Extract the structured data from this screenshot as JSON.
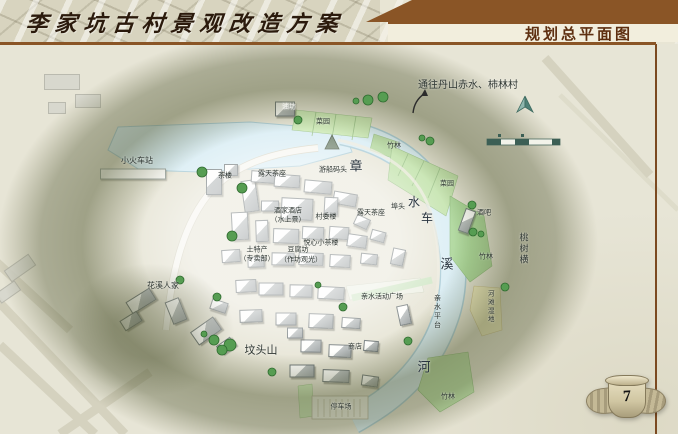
{
  "header": {
    "title_left": "李家坑古村景观改造方案",
    "title_right": "规划总平面图"
  },
  "page_number": "7",
  "colors": {
    "header_bar": "#8a5526",
    "rule_brown": "#7b4a21",
    "parchment": "#e7e5d6",
    "hill_shade": "#5d633e",
    "water": "#d9edf4",
    "water_edge": "#a9cbd6",
    "garden_green": "#cdeab6",
    "bamboo_green": "#a9d596",
    "wetland_yellow": "#eee9bd",
    "road": "#f7f6f0",
    "building_roof": "#9aa0a1",
    "tree_green": "#569d52",
    "north_arrow": "#4e8076",
    "emblem_stone": "#c9bfa4"
  },
  "map": {
    "route_note": "通往丹山赤水、柿林村",
    "river_name": "章溪河",
    "labels": [
      {
        "t": "通往丹山赤水、柿林村",
        "x": 468,
        "y": 86,
        "s": 10
      },
      {
        "t": "小火车站",
        "x": 137,
        "y": 161,
        "s": 8
      },
      {
        "t": "油坊",
        "x": 289,
        "y": 107,
        "s": 7,
        "c": "#f2f2ee"
      },
      {
        "t": "菜园",
        "x": 323,
        "y": 122,
        "s": 7
      },
      {
        "t": "竹林",
        "x": 394,
        "y": 146,
        "s": 7
      },
      {
        "t": "菜园",
        "x": 447,
        "y": 184,
        "s": 7
      },
      {
        "t": "茶楼",
        "x": 225,
        "y": 176,
        "s": 7
      },
      {
        "t": "露天茶座",
        "x": 272,
        "y": 174,
        "s": 7
      },
      {
        "t": "游船码头",
        "x": 333,
        "y": 170,
        "s": 7
      },
      {
        "t": "埠头",
        "x": 398,
        "y": 207,
        "s": 7
      },
      {
        "t": "露天茶座",
        "x": 371,
        "y": 213,
        "s": 7
      },
      {
        "t": "酒家酒店",
        "x": 288,
        "y": 211,
        "s": 7
      },
      {
        "t": "（水上景）",
        "x": 288,
        "y": 220,
        "s": 7
      },
      {
        "t": "村委楼",
        "x": 326,
        "y": 217,
        "s": 7
      },
      {
        "t": "酒吧",
        "x": 484,
        "y": 213,
        "s": 7
      },
      {
        "t": "悦心小茶楼",
        "x": 321,
        "y": 243,
        "s": 7
      },
      {
        "t": "土特产",
        "x": 257,
        "y": 250,
        "s": 7
      },
      {
        "t": "（专卖部）",
        "x": 257,
        "y": 259,
        "s": 7
      },
      {
        "t": "豆腐坊",
        "x": 298,
        "y": 250,
        "s": 7
      },
      {
        "t": "（作坊观光）",
        "x": 301,
        "y": 260,
        "s": 7
      },
      {
        "t": "章",
        "x": 356,
        "y": 166,
        "s": 13,
        "c": "#2a3540"
      },
      {
        "t": "水",
        "x": 414,
        "y": 202,
        "s": 12,
        "c": "#2a3540"
      },
      {
        "t": "车",
        "x": 427,
        "y": 218,
        "s": 12,
        "c": "#2a3540"
      },
      {
        "t": "溪",
        "x": 447,
        "y": 264,
        "s": 13,
        "c": "#2a3540"
      },
      {
        "t": "河",
        "x": 424,
        "y": 367,
        "s": 13,
        "c": "#2a3540"
      },
      {
        "t": "桃树横",
        "x": 523,
        "y": 249,
        "s": 9,
        "v": true
      },
      {
        "t": "竹林",
        "x": 486,
        "y": 257,
        "s": 7
      },
      {
        "t": "河滩湿地",
        "x": 489,
        "y": 307,
        "s": 6.5,
        "v": true
      },
      {
        "t": "亲水平台",
        "x": 437,
        "y": 312,
        "s": 7,
        "v": true
      },
      {
        "t": "亲水活动广场",
        "x": 382,
        "y": 297,
        "s": 7
      },
      {
        "t": "商店",
        "x": 355,
        "y": 347,
        "s": 7
      },
      {
        "t": "花溪人家",
        "x": 163,
        "y": 286,
        "s": 8
      },
      {
        "t": "坟头山",
        "x": 261,
        "y": 351,
        "s": 11
      },
      {
        "t": "停车场",
        "x": 341,
        "y": 407,
        "s": 7
      },
      {
        "t": "竹林",
        "x": 448,
        "y": 397,
        "s": 7
      }
    ],
    "trees": [
      [
        368,
        100,
        5
      ],
      [
        383,
        97,
        5
      ],
      [
        356,
        101,
        3
      ],
      [
        298,
        120,
        4
      ],
      [
        202,
        172,
        5
      ],
      [
        242,
        188,
        5
      ],
      [
        232,
        236,
        5
      ],
      [
        180,
        280,
        4
      ],
      [
        217,
        297,
        4
      ],
      [
        214,
        340,
        5
      ],
      [
        230,
        345,
        6
      ],
      [
        222,
        350,
        5
      ],
      [
        204,
        334,
        3
      ],
      [
        272,
        372,
        4
      ],
      [
        343,
        307,
        4
      ],
      [
        318,
        285,
        3
      ],
      [
        408,
        341,
        4
      ],
      [
        473,
        232,
        4
      ],
      [
        481,
        234,
        3
      ],
      [
        505,
        287,
        4
      ],
      [
        472,
        205,
        4
      ],
      [
        430,
        141,
        4
      ],
      [
        422,
        138,
        3
      ]
    ],
    "buildings": [
      [
        62,
        82,
        34,
        14,
        0,
        1
      ],
      [
        88,
        101,
        24,
        12,
        0,
        1
      ],
      [
        57,
        108,
        16,
        10,
        0,
        1
      ],
      [
        20,
        268,
        28,
        12,
        -35,
        1
      ],
      [
        8,
        292,
        22,
        10,
        -35,
        1
      ],
      [
        133,
        174,
        64,
        9,
        0,
        2
      ],
      [
        285,
        109,
        18,
        13,
        0
      ],
      [
        214,
        182,
        14,
        24,
        0
      ],
      [
        231,
        170,
        12,
        10,
        0
      ],
      [
        250,
        196,
        13,
        30,
        -8
      ],
      [
        263,
        177,
        22,
        10,
        4
      ],
      [
        287,
        181,
        24,
        11,
        4
      ],
      [
        318,
        187,
        26,
        11,
        5
      ],
      [
        345,
        199,
        22,
        11,
        10
      ],
      [
        270,
        206,
        16,
        9,
        0
      ],
      [
        297,
        209,
        30,
        20,
        3
      ],
      [
        331,
        206,
        12,
        16,
        3
      ],
      [
        362,
        222,
        13,
        9,
        25
      ],
      [
        240,
        226,
        15,
        26,
        -3
      ],
      [
        262,
        231,
        11,
        20,
        -2
      ],
      [
        286,
        236,
        24,
        13,
        2
      ],
      [
        313,
        233,
        20,
        11,
        3
      ],
      [
        339,
        233,
        18,
        11,
        4
      ],
      [
        357,
        241,
        18,
        11,
        8
      ],
      [
        378,
        236,
        13,
        9,
        15
      ],
      [
        231,
        256,
        17,
        11,
        -4
      ],
      [
        256,
        262,
        15,
        9,
        -2
      ],
      [
        283,
        259,
        21,
        11,
        1
      ],
      [
        311,
        259,
        23,
        11,
        2
      ],
      [
        340,
        261,
        19,
        11,
        3
      ],
      [
        369,
        259,
        15,
        9,
        6
      ],
      [
        398,
        257,
        11,
        15,
        12
      ],
      [
        246,
        286,
        19,
        11,
        -3
      ],
      [
        271,
        289,
        23,
        11,
        0
      ],
      [
        301,
        291,
        21,
        11,
        1
      ],
      [
        331,
        293,
        25,
        11,
        3
      ],
      [
        219,
        306,
        15,
        9,
        18
      ],
      [
        251,
        316,
        21,
        11,
        -2
      ],
      [
        286,
        319,
        19,
        11,
        0
      ],
      [
        321,
        321,
        23,
        13,
        2
      ],
      [
        351,
        323,
        17,
        9,
        4
      ],
      [
        311,
        346,
        19,
        11,
        1
      ],
      [
        340,
        351,
        21,
        11,
        2
      ],
      [
        371,
        346,
        13,
        9,
        5
      ],
      [
        302,
        371,
        23,
        11,
        0
      ],
      [
        336,
        376,
        25,
        11,
        2
      ],
      [
        370,
        381,
        15,
        9,
        8
      ],
      [
        467,
        221,
        9,
        22,
        20
      ],
      [
        404,
        315,
        10,
        18,
        -12
      ],
      [
        295,
        333,
        14,
        9,
        0
      ],
      [
        141,
        301,
        26,
        12,
        -32
      ],
      [
        131,
        321,
        18,
        10,
        -32
      ],
      [
        176,
        311,
        13,
        22,
        -22
      ],
      [
        206,
        331,
        26,
        14,
        -35
      ],
      [
        226,
        346,
        15,
        9,
        -35
      ]
    ]
  }
}
